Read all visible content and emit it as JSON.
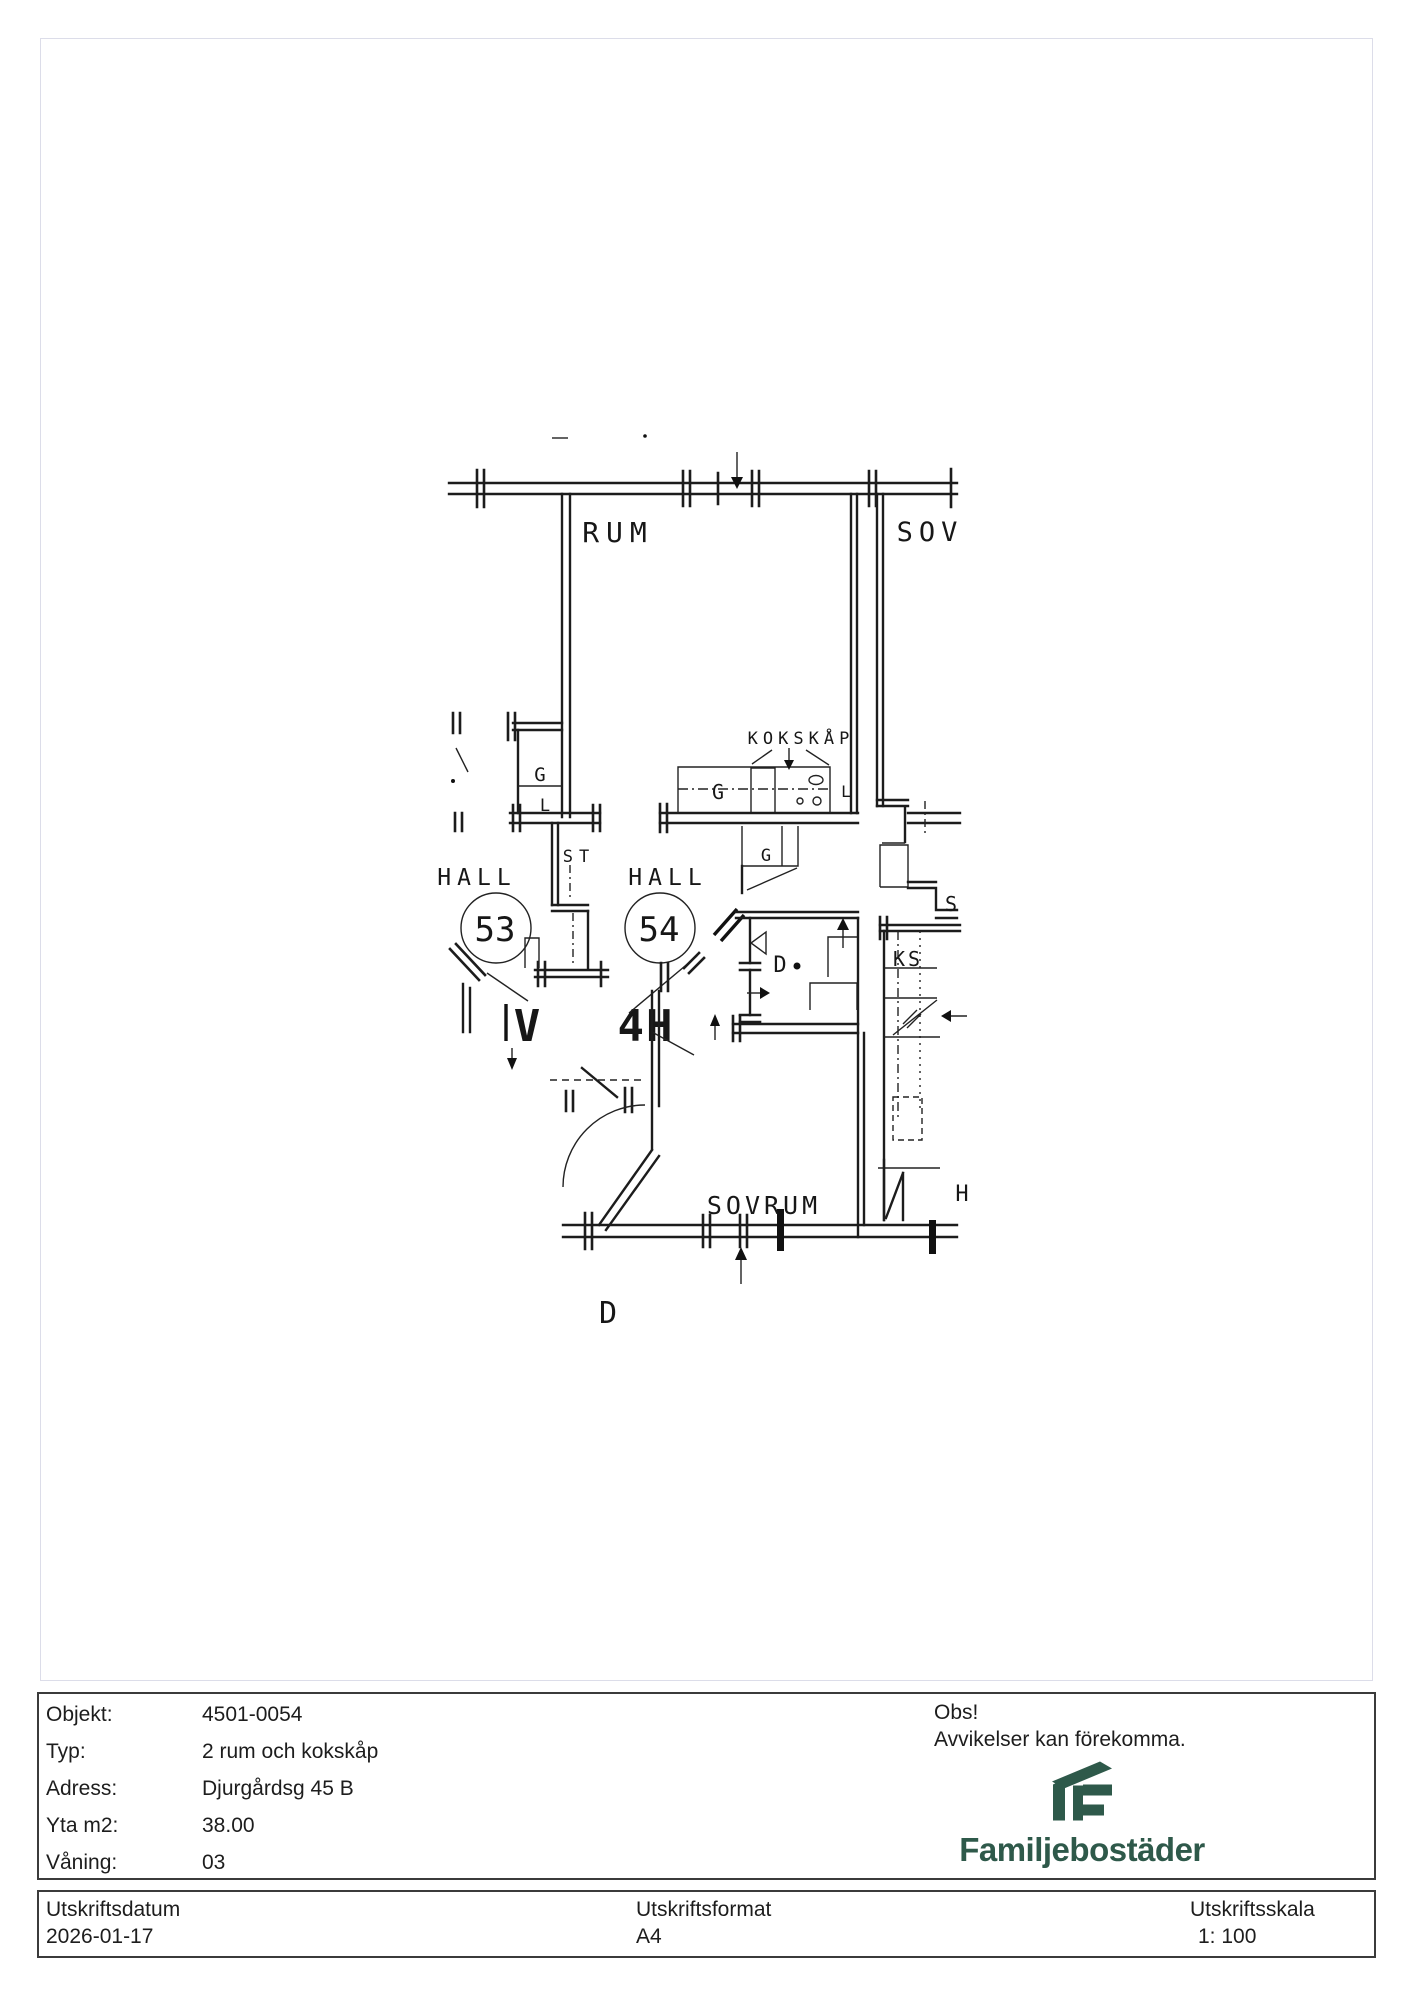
{
  "plan": {
    "labels": {
      "rum": "RUM",
      "sov": "SOV",
      "kokskap": "KOKSKÅP",
      "hall53": "HALL",
      "hall54": "HALL",
      "apt53": "53",
      "apt54": "54",
      "tag53": "V",
      "tag54": "4H",
      "closet_g1": "G",
      "closet_l1": "L",
      "kitchen_g": "G",
      "kitchen_l": "L",
      "hall_g": "G",
      "st": "ST",
      "shower_d": "D",
      "shaft_s": "S",
      "shaft_ks": "KS",
      "sovrum": "SOVRUM",
      "cut_h": "H",
      "cut_d": "D"
    }
  },
  "info": {
    "rows": [
      {
        "label": "Objekt:",
        "value": "4501-0054"
      },
      {
        "label": "Typ:",
        "value": "2 rum och kokskåp"
      },
      {
        "label": "Adress:",
        "value": "Djurgårdsg 45 B"
      },
      {
        "label": "Yta m2:",
        "value": "38.00"
      },
      {
        "label": "Våning:",
        "value": "03"
      }
    ],
    "notice_title": "Obs!",
    "notice_text": "Avvikelser kan förekomma.",
    "brand_name": "Familjebostäder",
    "brand_color": "#2e594a"
  },
  "print": {
    "date_label": "Utskriftsdatum",
    "date_value": "2026-01-17",
    "format_label": "Utskriftsformat",
    "format_value": "A4",
    "scale_label": "Utskriftsskala",
    "scale_value": "1: 100"
  }
}
